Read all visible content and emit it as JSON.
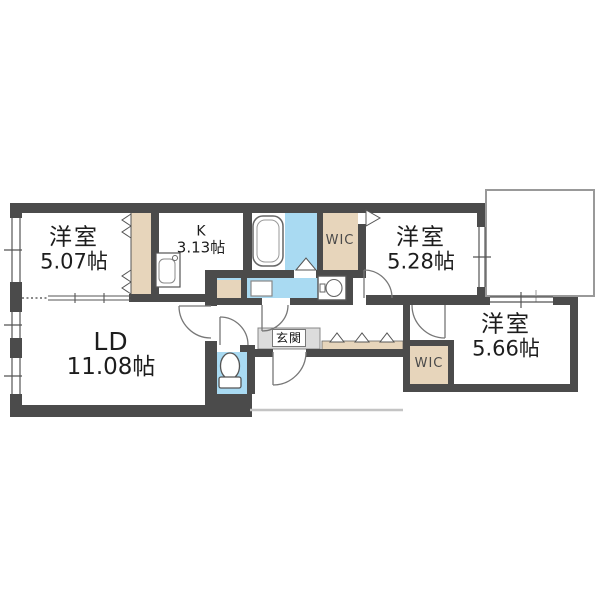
{
  "rooms": {
    "bedroom_west": {
      "label": "洋室",
      "size": "5.07帖"
    },
    "kitchen": {
      "label": "K",
      "size": "3.13帖"
    },
    "bedroom_north": {
      "label": "洋室",
      "size": "5.28帖"
    },
    "bedroom_east": {
      "label": "洋室",
      "size": "5.66帖"
    },
    "living_dining": {
      "label": "LD",
      "size": "11.08帖"
    },
    "wic_north": {
      "label": "WIC"
    },
    "wic_south": {
      "label": "WIC"
    },
    "entrance": {
      "label": "玄関"
    }
  },
  "fixtures": [
    "bathtub",
    "kitchen-sink",
    "washing-machine",
    "washbasin",
    "toilet"
  ],
  "colors": {
    "wall": "#4b4b4b",
    "wet_area": "#a9daf2",
    "closet": "#e7d5bb",
    "entrance_mat": "#dcdcdc",
    "balcony_outline": "#999999",
    "porch_outline": "#c4c4c4"
  }
}
